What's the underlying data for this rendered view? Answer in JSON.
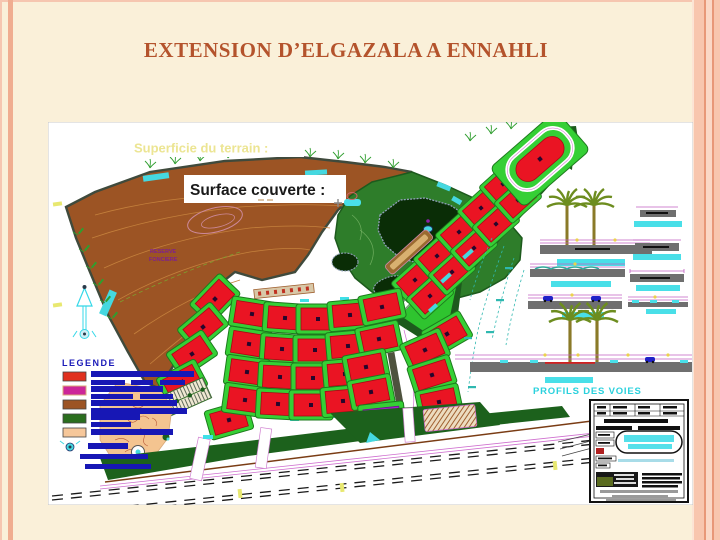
{
  "slide": {
    "title": "EXTENSION D’ELGAZALA A ENNAHLI"
  },
  "map": {
    "annotations": {
      "superficie_label": "Superficie du terrain :",
      "surface_label": "Surface couverte :",
      "reserve_line1": "RESERVE",
      "reserve_line2": "FONCIERE",
      "profils_label": "PROFILS DES VOIES"
    },
    "legend": {
      "title": "LEGENDE",
      "swatches": [
        {
          "name": "red-housing-blocks",
          "color": "#e0301e"
        },
        {
          "name": "magenta-zone",
          "color": "#cc2699"
        },
        {
          "name": "brown-terrain",
          "color": "#9c5424"
        },
        {
          "name": "green-spaces",
          "color": "#2a6e1e"
        },
        {
          "name": "tan-zone",
          "color": "#f6c79a"
        }
      ]
    },
    "colors": {
      "slide_background": "#faf0d9",
      "border_stripe": "#f0ad90",
      "title_text": "#b4532c",
      "terrain_brown": "#9c5424",
      "park_green": "#2e7d2a",
      "parcel_green": "#35cf35",
      "block_red": "#ea1423",
      "block_purple": "#a81fd4",
      "cyan_accent": "#45d8e0",
      "legend_text_bars": "#1717b5",
      "profiles_label_cyan": "#2ad1dd",
      "road_edge_magenta": "#cf6fcf",
      "superficie_text": "#ece593"
    }
  }
}
